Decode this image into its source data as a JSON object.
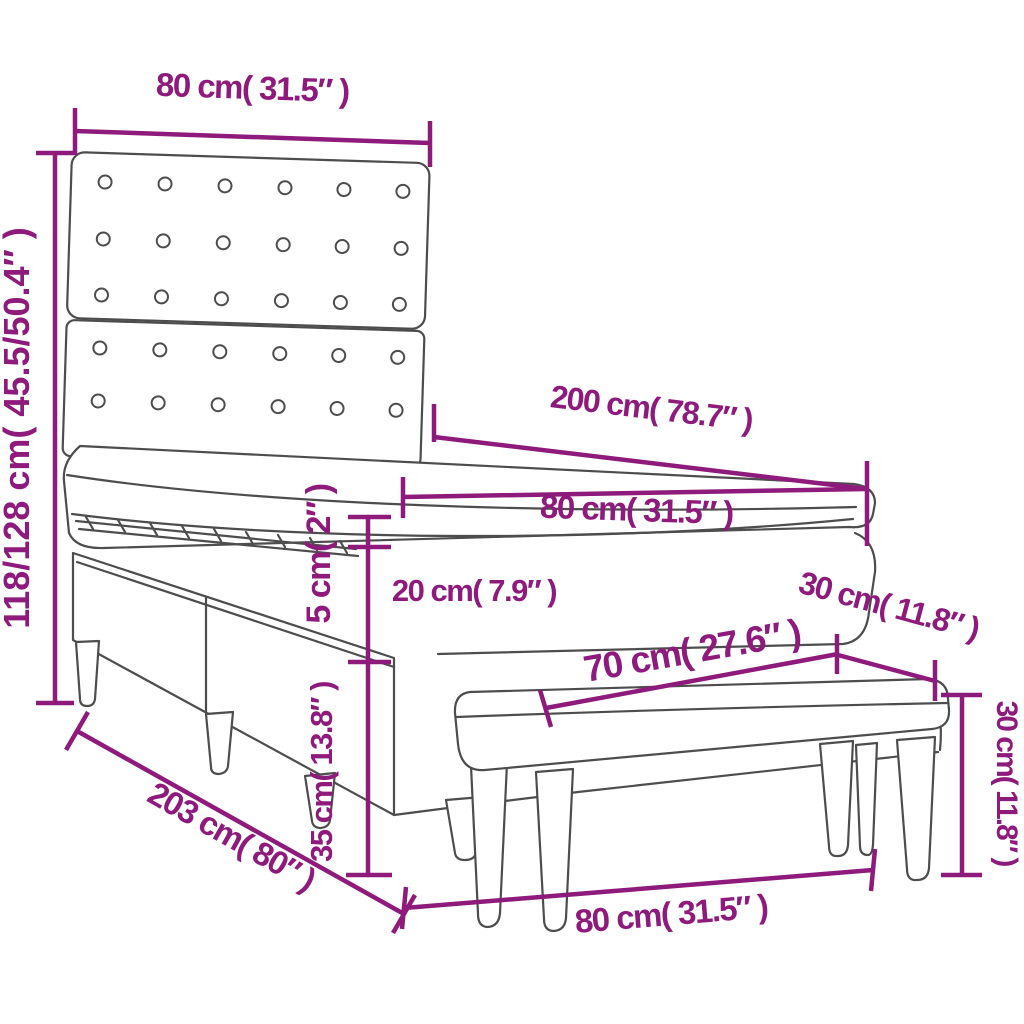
{
  "colors": {
    "accent": "#8e1b7c",
    "outline": "#4d4d4d",
    "background": "#ffffff"
  },
  "labels": {
    "headboard_width": "80 cm( 31.5″ )",
    "headboard_height": "118/128 cm( 45.5/50.4″ )",
    "bed_length": "200 cm( 78.7″ )",
    "bed_width": "80 cm( 31.5″ )",
    "topper_thickness": "5 cm( 2″ )",
    "mattress_thickness": "20 cm( 7.9″ )",
    "base_height": "35 cm( 13.8″ )",
    "bench_top_length": "70 cm( 27.6″ )",
    "bench_depth": "30 cm( 11.8″ )",
    "bench_height": "30 cm( 11.8″ )",
    "total_length": "203 cm( 80″ )",
    "bench_length": "80 cm( 31.5″ )"
  }
}
